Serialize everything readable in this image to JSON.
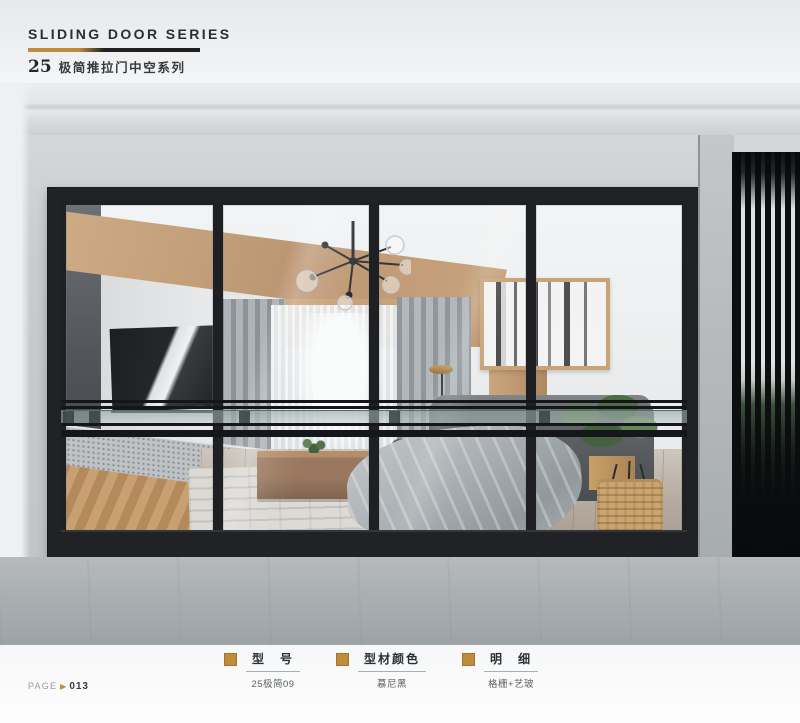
{
  "header": {
    "title_en": "SLIDING DOOR SERIES",
    "series_number": "25",
    "title_cn": "极简推拉门中空系列"
  },
  "specs": [
    {
      "label": "型　号",
      "value": "25极简09"
    },
    {
      "label": "型材颜色",
      "value": "慕尼黑"
    },
    {
      "label": "明　细",
      "value": "格栅+艺玻"
    }
  ],
  "footer": {
    "page_label": "PAGE",
    "arrow": "▶",
    "page_number": "013"
  },
  "colors": {
    "accent_gold": "#bf8c3c",
    "header_bar_dark": "#1d1d1f",
    "door_frame_black": "#202225"
  }
}
